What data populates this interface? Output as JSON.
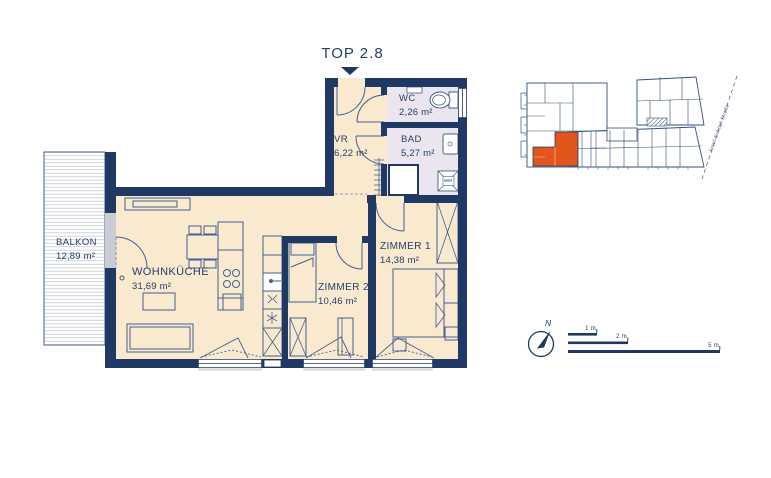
{
  "title": "TOP 2.8",
  "colors": {
    "wall": "#1f3864",
    "room_fill": "#f8e9cf",
    "wet_room_fill": "#eae5ee",
    "furniture_line": "#44618f",
    "highlight_orange": "#e2561b",
    "siteplan_line": "#33517e"
  },
  "rooms": {
    "balkon": {
      "name": "BALKON",
      "area": "12,89 m²"
    },
    "wohnkueche": {
      "name": "WOHNKÜCHE",
      "area": "31,69 m²"
    },
    "vr": {
      "name": "VR",
      "area": "6,22 m²"
    },
    "wc": {
      "name": "WC",
      "area": "2,26 m²"
    },
    "bad": {
      "name": "BAD",
      "area": "5,27 m²"
    },
    "zimmer1": {
      "name": "ZIMMER 1",
      "area": "14,38 m²"
    },
    "zimmer2": {
      "name": "ZIMMER 2",
      "area": "10,46 m²"
    }
  },
  "labels": {
    "washing_machine": "WM"
  },
  "site_plan": {
    "street": "Josef-Schöpf-Straße"
  },
  "compass": {
    "north": "N"
  },
  "scale_bar": {
    "m1": "1 m",
    "m2": "2 m",
    "m5": "5 m"
  }
}
